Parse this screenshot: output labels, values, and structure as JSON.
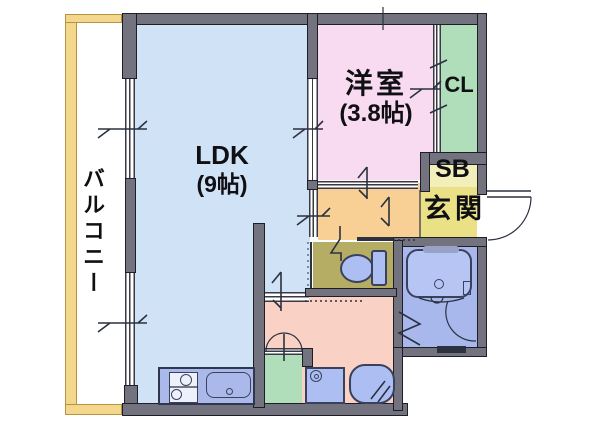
{
  "floorplan": {
    "balcony": {
      "label": "バルコニー"
    },
    "ldk": {
      "label": "LDK",
      "size": "(9帖)"
    },
    "western_room": {
      "label": "洋室",
      "size": "(3.8帖)"
    },
    "closet": {
      "label": "CL"
    },
    "shoe_box": {
      "label": "SB"
    },
    "entrance": {
      "label": "玄関"
    },
    "colors": {
      "wall": "#73737f",
      "balcony_wall": "#f2d78d",
      "ldk": "#d0e2f6",
      "western_room": "#f8dbf1",
      "closet": "#b0ddba",
      "shoe_box": "#f3efbb",
      "entrance": "#eae085",
      "hallway": "#f8d095",
      "toilet": "#b6ad64",
      "washroom": "#f9d2c5",
      "bathroom": "#a8b8ed",
      "fixture": "#adbef2",
      "counter": "#aab9ea"
    }
  }
}
